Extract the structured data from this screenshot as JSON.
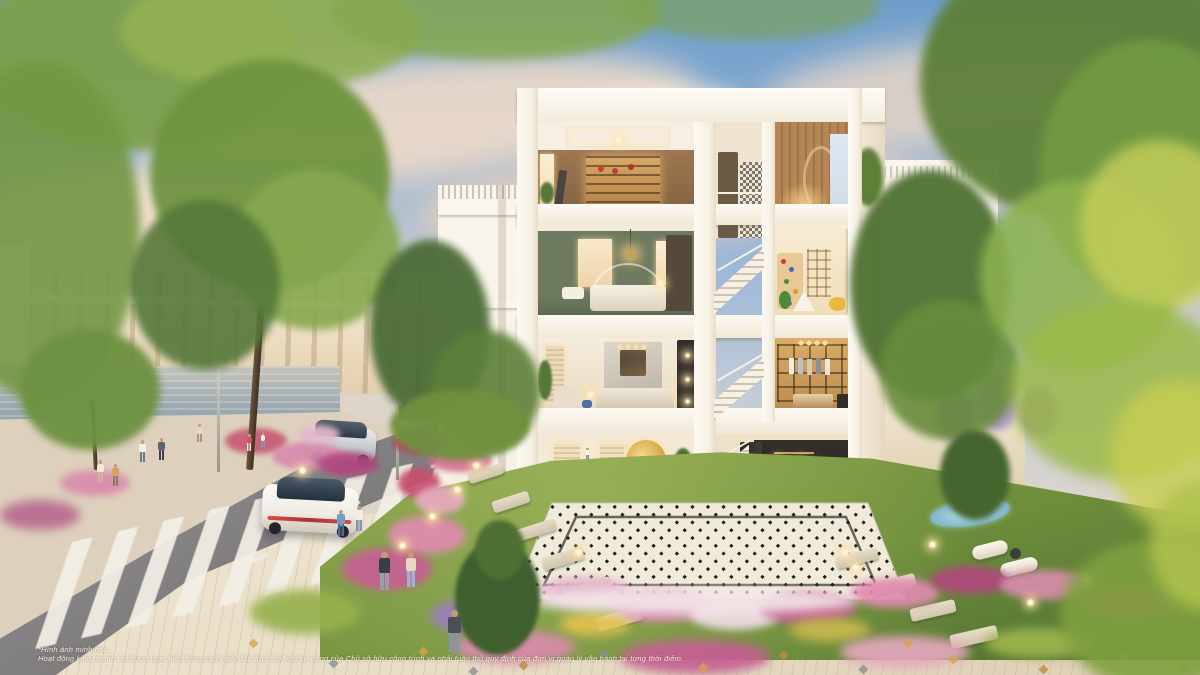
{
  "disclaimer": {
    "line1": "*Hình ảnh minh hoạ.",
    "line2": "Hoạt động kinh doanh chỉ được thực hiện trong ranh giới đất được sở hữu/sử dụng của Chủ sở hữu công trình và phải tuân thủ quy định của đơn vị quản lý vận hành tại từng thời điểm."
  },
  "palette": {
    "sky-top": "#6f9ecb",
    "horizon": "#eedcc2",
    "cloud": "#f6dec8",
    "building": "#f6f0e3",
    "townhouse": "#eee0c6",
    "road": "#7f7d7e",
    "stripe": "#f3f0e8",
    "sidewalk": "#ddd1bd",
    "pavement": "#e8ddc6",
    "water": "#9aa8b2",
    "grass": "#83a04a",
    "grass-dark": "#4e7030",
    "tile-base": "#f0ead9",
    "tile-line": "#1d1c1a",
    "green-wall": "#6d7a5f",
    "wood": "#a97c4f",
    "car-white": "#efece4",
    "car-silver": "#c3c7cc",
    "car-red": "#b04a50",
    "pool": "#7fb5c9",
    "glow": "#ffe2a0",
    "flower-pink": "#e08bb0",
    "flower-magenta": "#c75f93",
    "flower-purple": "#9a7fc0",
    "flower-white": "#f5f0e4",
    "flower-yellow": "#e2c24e",
    "leaf": "#6f9440",
    "leaf-bright": "#b5c956",
    "leaf-dark": "#42602f"
  },
  "scene": {
    "foliage": [
      {
        "x": -30,
        "y": -40,
        "w": 330,
        "h": 190,
        "c": "#7da04b",
        "b": 5,
        "o": 0.95
      },
      {
        "x": 120,
        "y": -30,
        "w": 300,
        "h": 120,
        "c": "#93b053",
        "b": 5,
        "o": 0.9
      },
      {
        "x": 330,
        "y": -35,
        "w": 330,
        "h": 95,
        "c": "#86a84e",
        "b": 5,
        "o": 0.85
      },
      {
        "x": -60,
        "y": 60,
        "w": 200,
        "h": 340,
        "c": "#739743",
        "b": 5,
        "o": 0.9
      },
      {
        "x": 20,
        "y": 330,
        "w": 140,
        "h": 120,
        "c": "#6d9140",
        "b": 4,
        "o": 0.95
      },
      {
        "x": 150,
        "y": 60,
        "w": 240,
        "h": 230,
        "c": "#6f9440",
        "b": 4,
        "o": 0.95
      },
      {
        "x": 230,
        "y": 170,
        "w": 170,
        "h": 160,
        "c": "#86a84e",
        "b": 4,
        "o": 0.9
      },
      {
        "x": 130,
        "y": 200,
        "w": 150,
        "h": 170,
        "c": "#55783a",
        "b": 4,
        "o": 0.9
      },
      {
        "x": 370,
        "y": 240,
        "w": 120,
        "h": 180,
        "c": "#4c6c36",
        "b": 4,
        "o": 0.95
      },
      {
        "x": 430,
        "y": 330,
        "w": 110,
        "h": 120,
        "c": "#5d8038",
        "b": 4,
        "o": 0.9
      },
      {
        "x": 390,
        "y": 390,
        "w": 140,
        "h": 70,
        "c": "#70913f",
        "b": 3,
        "o": 0.95
      },
      {
        "x": 850,
        "y": 170,
        "w": 160,
        "h": 230,
        "c": "#4f7233",
        "b": 4,
        "o": 0.95
      },
      {
        "x": 880,
        "y": 300,
        "w": 140,
        "h": 140,
        "c": "#678c3b",
        "b": 4,
        "o": 0.9
      },
      {
        "x": 920,
        "y": -60,
        "w": 320,
        "h": 280,
        "c": "#5d8038",
        "b": 5,
        "o": 0.95
      },
      {
        "x": 1040,
        "y": 40,
        "w": 220,
        "h": 260,
        "c": "#729b43",
        "b": 5,
        "o": 0.9
      },
      {
        "x": 980,
        "y": 180,
        "w": 200,
        "h": 190,
        "c": "#8fb44e",
        "b": 5,
        "o": 0.85
      },
      {
        "x": 1080,
        "y": 140,
        "w": 160,
        "h": 170,
        "c": "#c6cf5a",
        "b": 6,
        "o": 0.8
      },
      {
        "x": 1010,
        "y": 300,
        "w": 220,
        "h": 180,
        "c": "#9cb948",
        "b": 7,
        "o": 0.85
      },
      {
        "x": 1110,
        "y": 380,
        "w": 140,
        "h": 150,
        "c": "#c8cf52",
        "b": 8,
        "o": 0.8
      },
      {
        "x": 1060,
        "y": 540,
        "w": 190,
        "h": 150,
        "c": "#7fa03e",
        "b": 6,
        "o": 0.9
      },
      {
        "x": 1150,
        "y": 480,
        "w": 110,
        "h": 130,
        "c": "#b0c24e",
        "b": 7,
        "o": 0.85
      },
      {
        "x": 455,
        "y": 540,
        "w": 85,
        "h": 115,
        "c": "#3f5f2e",
        "b": 2,
        "o": 1
      },
      {
        "x": 475,
        "y": 520,
        "w": 50,
        "h": 60,
        "c": "#4e7034",
        "b": 2,
        "o": 1
      },
      {
        "x": 940,
        "y": 430,
        "w": 70,
        "h": 90,
        "c": "#45652f",
        "b": 3,
        "o": 1
      },
      {
        "x": 620,
        "y": -30,
        "w": 260,
        "h": 70,
        "c": "#7da04b",
        "b": 6,
        "o": 0.6
      }
    ],
    "flowers": [
      {
        "x": 225,
        "y": 428,
        "w": 62,
        "h": 26,
        "c": "#c75a74",
        "b": 3
      },
      {
        "x": 272,
        "y": 442,
        "w": 72,
        "h": 28,
        "c": "#d98bad",
        "b": 3
      },
      {
        "x": 318,
        "y": 452,
        "w": 60,
        "h": 24,
        "c": "#b1487e",
        "b": 3
      },
      {
        "x": 298,
        "y": 425,
        "w": 42,
        "h": 18,
        "c": "#e3b8cc",
        "b": 3
      },
      {
        "x": 392,
        "y": 430,
        "w": 58,
        "h": 24,
        "c": "#b5485f",
        "b": 3
      },
      {
        "x": 428,
        "y": 448,
        "w": 64,
        "h": 24,
        "c": "#d1718f",
        "b": 3
      },
      {
        "x": 398,
        "y": 468,
        "w": 42,
        "h": 30,
        "c": "#c94f6e",
        "b": 3
      },
      {
        "x": 415,
        "y": 486,
        "w": 50,
        "h": 28,
        "c": "#e6a8bf",
        "b": 3
      },
      {
        "x": 388,
        "y": 516,
        "w": 78,
        "h": 38,
        "c": "#e08bb0",
        "b": 4
      },
      {
        "x": 342,
        "y": 548,
        "w": 90,
        "h": 42,
        "c": "#c75f93",
        "b": 4
      },
      {
        "x": 250,
        "y": 590,
        "w": 110,
        "h": 44,
        "c": "#97b14c",
        "b": 5
      },
      {
        "x": 430,
        "y": 598,
        "w": 95,
        "h": 36,
        "c": "#9a7fc0",
        "b": 5
      },
      {
        "x": 540,
        "y": 576,
        "w": 90,
        "h": 30,
        "c": "#e7b6ce",
        "b": 4
      },
      {
        "x": 610,
        "y": 590,
        "w": 100,
        "h": 32,
        "c": "#d886ad",
        "b": 4
      },
      {
        "x": 690,
        "y": 600,
        "w": 90,
        "h": 30,
        "c": "#f0dce6",
        "b": 4
      },
      {
        "x": 760,
        "y": 592,
        "w": 95,
        "h": 32,
        "c": "#c75f93",
        "b": 4
      },
      {
        "x": 850,
        "y": 578,
        "w": 90,
        "h": 30,
        "c": "#e08bb0",
        "b": 4
      },
      {
        "x": 930,
        "y": 566,
        "w": 80,
        "h": 28,
        "c": "#b1487e",
        "b": 4
      },
      {
        "x": 1000,
        "y": 570,
        "w": 90,
        "h": 30,
        "c": "#d98bad",
        "b": 4
      },
      {
        "x": 1085,
        "y": 588,
        "w": 90,
        "h": 32,
        "c": "#c75a74",
        "b": 5
      },
      {
        "x": 560,
        "y": 612,
        "w": 70,
        "h": 24,
        "c": "#e2c24e",
        "b": 5
      },
      {
        "x": 790,
        "y": 618,
        "w": 80,
        "h": 24,
        "c": "#c9b84e",
        "b": 5
      },
      {
        "x": 935,
        "y": 388,
        "w": 40,
        "h": 52,
        "c": "#9a7fc0",
        "b": 4
      },
      {
        "x": 975,
        "y": 372,
        "w": 44,
        "h": 58,
        "c": "#a98fd0",
        "b": 4
      },
      {
        "x": 1020,
        "y": 388,
        "w": 38,
        "h": 48,
        "c": "#8f74b8",
        "b": 4
      },
      {
        "x": 905,
        "y": 330,
        "w": 90,
        "h": 60,
        "c": "#6d8f3f",
        "b": 4
      },
      {
        "x": 528,
        "y": 588,
        "w": 330,
        "h": 26,
        "c": "#f3e6ea",
        "b": 5
      },
      {
        "x": 455,
        "y": 630,
        "w": 120,
        "h": 34,
        "c": "#d98bad",
        "b": 5
      },
      {
        "x": 620,
        "y": 640,
        "w": 150,
        "h": 34,
        "c": "#c75f93",
        "b": 5
      },
      {
        "x": 840,
        "y": 636,
        "w": 130,
        "h": 32,
        "c": "#e6a8bf",
        "b": 5
      },
      {
        "x": 985,
        "y": 628,
        "w": 110,
        "h": 30,
        "c": "#9db54e",
        "b": 5
      },
      {
        "x": 60,
        "y": 470,
        "w": 70,
        "h": 26,
        "c": "#d98bad",
        "b": 4
      },
      {
        "x": 0,
        "y": 500,
        "w": 80,
        "h": 30,
        "c": "#b86a8e",
        "b": 5
      }
    ],
    "stones": [
      {
        "x": 468,
        "y": 468,
        "w": 36,
        "h": 11,
        "rot": -18
      },
      {
        "x": 492,
        "y": 496,
        "w": 38,
        "h": 12,
        "rot": -18
      },
      {
        "x": 516,
        "y": 524,
        "w": 40,
        "h": 12,
        "rot": -18
      },
      {
        "x": 542,
        "y": 552,
        "w": 42,
        "h": 13,
        "rot": -17
      },
      {
        "x": 568,
        "y": 582,
        "w": 44,
        "h": 13,
        "rot": -17
      },
      {
        "x": 596,
        "y": 612,
        "w": 46,
        "h": 14,
        "rot": -16
      },
      {
        "x": 836,
        "y": 552,
        "w": 42,
        "h": 12,
        "rot": -14
      },
      {
        "x": 872,
        "y": 578,
        "w": 44,
        "h": 13,
        "rot": -14
      },
      {
        "x": 910,
        "y": 604,
        "w": 46,
        "h": 13,
        "rot": -13
      },
      {
        "x": 950,
        "y": 630,
        "w": 48,
        "h": 14,
        "rot": -13
      }
    ],
    "flecks": [
      {
        "x": 250,
        "y": 640,
        "c": "#d7a44a"
      },
      {
        "x": 330,
        "y": 660,
        "c": "#8a8f96"
      },
      {
        "x": 420,
        "y": 648,
        "c": "#d7a44a"
      },
      {
        "x": 520,
        "y": 662,
        "c": "#c08a3e"
      },
      {
        "x": 600,
        "y": 650,
        "c": "#8a8f96"
      },
      {
        "x": 700,
        "y": 664,
        "c": "#d7a44a"
      },
      {
        "x": 780,
        "y": 652,
        "c": "#c08a3e"
      },
      {
        "x": 860,
        "y": 666,
        "c": "#8a8f96"
      },
      {
        "x": 950,
        "y": 656,
        "c": "#d7a44a"
      },
      {
        "x": 1040,
        "y": 666,
        "c": "#c08a3e"
      },
      {
        "x": 1120,
        "y": 652,
        "c": "#8a8f96"
      },
      {
        "x": 1180,
        "y": 664,
        "c": "#d7a44a"
      },
      {
        "x": 470,
        "y": 668,
        "c": "#8a8f96"
      },
      {
        "x": 905,
        "y": 640,
        "c": "#d7a44a"
      }
    ],
    "lights": [
      {
        "x": 400,
        "y": 543
      },
      {
        "x": 430,
        "y": 514
      },
      {
        "x": 455,
        "y": 487
      },
      {
        "x": 474,
        "y": 463
      },
      {
        "x": 576,
        "y": 550
      },
      {
        "x": 843,
        "y": 550
      },
      {
        "x": 853,
        "y": 565
      },
      {
        "x": 930,
        "y": 542
      },
      {
        "x": 1085,
        "y": 578
      },
      {
        "x": 300,
        "y": 468
      },
      {
        "x": 1028,
        "y": 600
      }
    ],
    "dashes": [
      {
        "x": 470,
        "y": 444,
        "rot": -33,
        "w": 15
      },
      {
        "x": 430,
        "y": 462,
        "rot": -31,
        "w": 15
      },
      {
        "x": 388,
        "y": 482,
        "rot": -29,
        "w": 16
      },
      {
        "x": 345,
        "y": 504,
        "rot": -27,
        "w": 16
      },
      {
        "x": 298,
        "y": 530,
        "rot": -25,
        "w": 17
      },
      {
        "x": 540,
        "y": 428,
        "rot": -36,
        "w": 14
      },
      {
        "x": 588,
        "y": 414,
        "rot": -38,
        "w": 13
      },
      {
        "x": 252,
        "y": 556,
        "rot": -24,
        "w": 17
      }
    ],
    "people": [
      {
        "x": 96,
        "y": 460,
        "s": 1.0,
        "shirt": "#f2ead8",
        "pants": "#c9b9a0",
        "name": "pedestrian"
      },
      {
        "x": 111,
        "y": 464,
        "s": 1.0,
        "shirt": "#d9a05e",
        "pants": "#8a7a64",
        "name": "pedestrian"
      },
      {
        "x": 138,
        "y": 440,
        "s": 1.0,
        "shirt": "#f5f0e4",
        "pants": "#6b7b8c",
        "name": "pedestrian"
      },
      {
        "x": 157,
        "y": 438,
        "s": 1.0,
        "shirt": "#5a6470",
        "pants": "#3c4250",
        "name": "pedestrian"
      },
      {
        "x": 196,
        "y": 424,
        "s": 0.8,
        "shirt": "#e8d8c0",
        "pants": "#a89880",
        "name": "pedestrian"
      },
      {
        "x": 246,
        "y": 434,
        "s": 0.75,
        "shirt": "#c9566a",
        "pants": "#ece4d4",
        "name": "pedestrian"
      },
      {
        "x": 260,
        "y": 432,
        "s": 0.7,
        "shirt": "#f6f2e8",
        "pants": "#8898aa",
        "name": "pedestrian"
      },
      {
        "x": 336,
        "y": 510,
        "s": 1.15,
        "shirt": "#6f9ec9",
        "pants": "#4e6b8c",
        "name": "pedestrian-blue-shirt"
      },
      {
        "x": 354,
        "y": 506,
        "s": 1.1,
        "shirt": "#f2ede2",
        "pants": "#7e95b5",
        "name": "pedestrian-photographer"
      },
      {
        "x": 377,
        "y": 552,
        "s": 1.7,
        "shirt": "#3a3f45",
        "pants": "#9aa0a8",
        "name": "jogger-man"
      },
      {
        "x": 404,
        "y": 552,
        "s": 1.55,
        "shirt": "#e8d5c2",
        "pants": "#9db3cf",
        "name": "jogger-woman"
      },
      {
        "x": 446,
        "y": 610,
        "s": 1.9,
        "shirt": "#4a4f57",
        "pants": "#8895a8",
        "name": "pedestrian-foreground"
      },
      {
        "x": 585,
        "y": 448,
        "s": 0.55,
        "shirt": "#fff",
        "pants": "#999",
        "name": "pedestrian-distant"
      }
    ]
  }
}
